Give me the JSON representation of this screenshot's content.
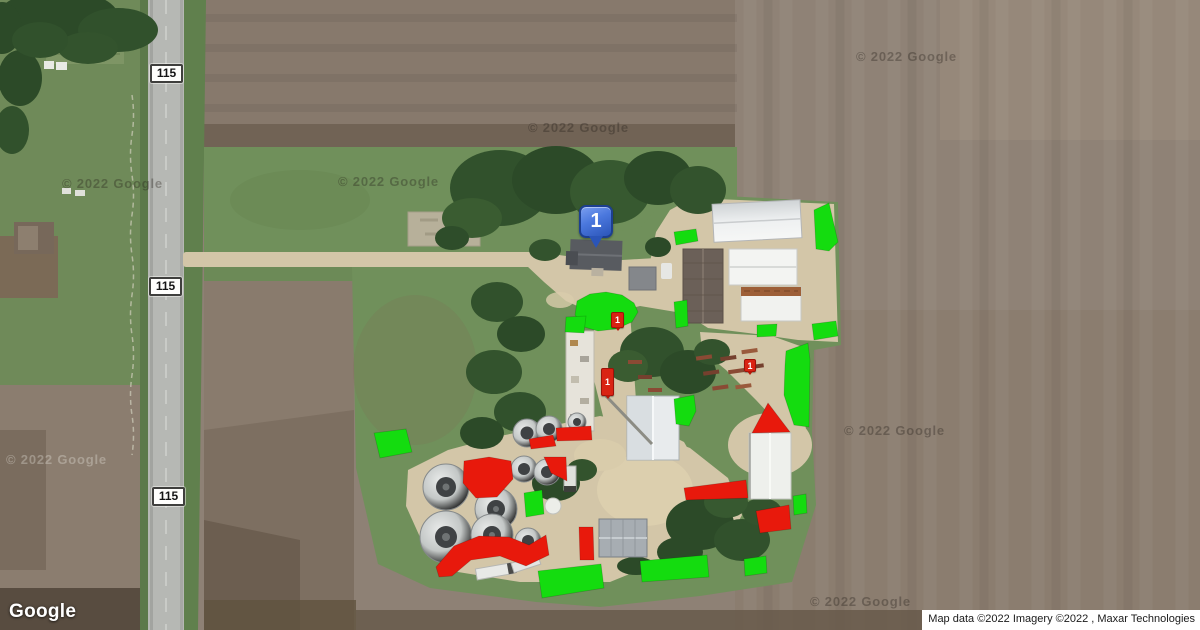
{
  "map": {
    "provider_logo": "Google",
    "attribution": "Map data ©2022 Imagery ©2022 , Maxar Technologies",
    "watermark_text": "© 2022 Google",
    "primary_marker": {
      "label": "1"
    },
    "colors": {
      "annotation_green": "#14dc0f",
      "annotation_red": "#e8190c",
      "marker_blue_top": "#7b9ff0",
      "marker_blue_bottom": "#2b55b8",
      "shield_background": "#fefefc",
      "shield_border": "#3f3f3d"
    }
  },
  "annotations": {
    "route_shields": [
      {
        "label": "115",
        "cx": 166,
        "cy": 74
      },
      {
        "label": "115",
        "cx": 165,
        "cy": 287
      },
      {
        "label": "115",
        "cx": 168,
        "cy": 497
      }
    ],
    "watermarks": [
      {
        "x": 62,
        "y": 176,
        "variant": "dark"
      },
      {
        "x": 338,
        "y": 174,
        "variant": "dark"
      },
      {
        "x": 528,
        "y": 120,
        "variant": "dark"
      },
      {
        "x": 856,
        "y": 49,
        "variant": "dark"
      },
      {
        "x": 844,
        "y": 423,
        "variant": "dark"
      },
      {
        "x": 6,
        "y": 452,
        "variant": "light"
      },
      {
        "x": 810,
        "y": 594,
        "variant": "dark"
      }
    ],
    "mini_markers": [
      {
        "label": "1",
        "x": 611,
        "y": 312,
        "w": 13,
        "h": 16
      },
      {
        "label": "1",
        "x": 601,
        "y": 368,
        "w": 13,
        "h": 28
      },
      {
        "label": "1",
        "x": 744,
        "y": 359,
        "w": 12,
        "h": 13
      }
    ],
    "green_zones": [
      {
        "points": "814,210 829,203 838,242 829,251 816,249"
      },
      {
        "points": "674,232 696,229 698,241 676,245"
      },
      {
        "points": "674,302 687,300 688,326 676,328"
      },
      {
        "points": "757,325 777,324 776,336 757,337"
      },
      {
        "points": "812,324 836,321 838,336 814,340"
      },
      {
        "points": "577,301 590,294 606,292 622,295 634,303 638,312 632,322 616,329 598,331 584,327 575,315"
      },
      {
        "points": "566,317 586,316 584,333 565,332"
      },
      {
        "points": "786,351 808,343 810,360 809,427 794,425 784,395 785,365"
      },
      {
        "points": "674,399 694,395 696,411 689,426 676,424"
      },
      {
        "points": "793,496 806,494 807,513 794,515"
      },
      {
        "points": "374,433 406,429 412,452 380,458"
      },
      {
        "points": "524,493 542,490 544,514 526,517"
      },
      {
        "points": "538,571 601,564 604,588 542,598"
      },
      {
        "points": "640,561 707,555 709,577 642,582"
      },
      {
        "points": "744,559 766,556 767,573 745,576"
      }
    ],
    "red_zones": [
      {
        "points": "556,428 591,426 592,440 557,441"
      },
      {
        "points": "529,439 553,435 556,446 531,449"
      },
      {
        "points": "464,461 489,457 511,461 513,479 497,497 476,498 463,483"
      },
      {
        "points": "544,457 566,457 567,481 551,473"
      },
      {
        "points": "436,567 454,546 479,536 509,537 529,545 546,535 549,555 526,566 500,556 471,560 452,576 439,577"
      },
      {
        "points": "579,527 593,527 594,560 580,560"
      },
      {
        "points": "684,488 746,480 748,498 686,500"
      },
      {
        "points": "756,511 789,505 791,529 760,533"
      },
      {
        "points": "768,403 790,432 752,433"
      }
    ]
  }
}
